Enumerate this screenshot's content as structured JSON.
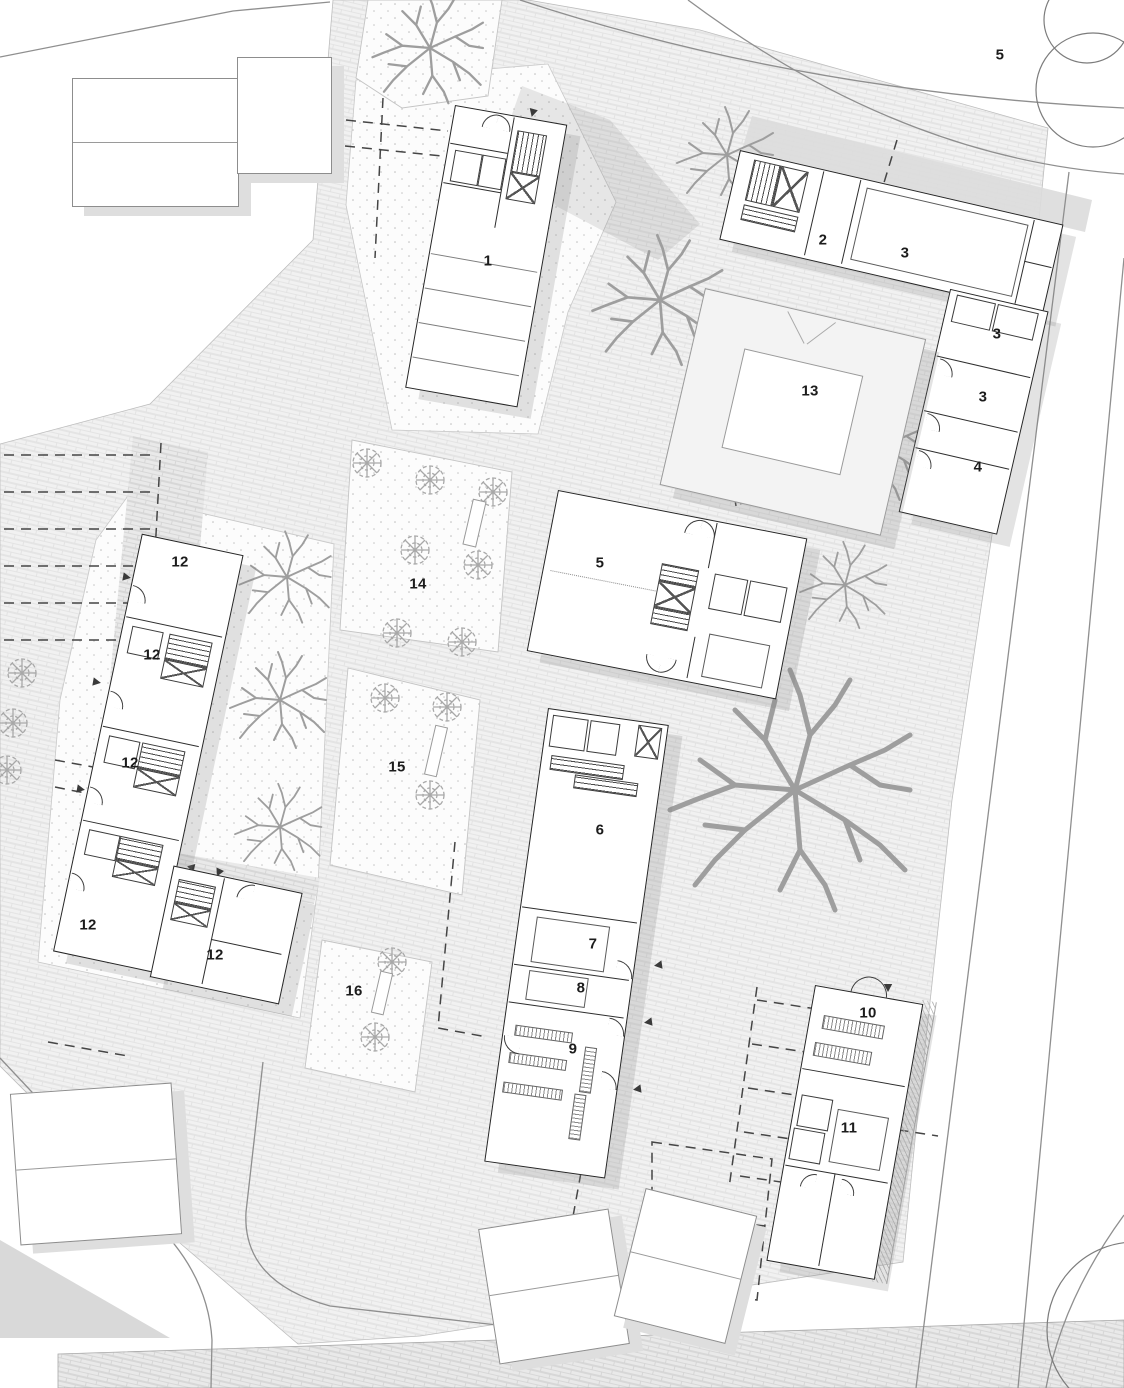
{
  "plan": {
    "title": "residential-site-plan",
    "labels": [
      {
        "id": "bld-1",
        "text": "1",
        "x": 488,
        "y": 261
      },
      {
        "id": "bld-2",
        "text": "2",
        "x": 823,
        "y": 240
      },
      {
        "id": "room-3a",
        "text": "3",
        "x": 905,
        "y": 253
      },
      {
        "id": "room-3b",
        "text": "3",
        "x": 997,
        "y": 334
      },
      {
        "id": "room-3c",
        "text": "3",
        "x": 983,
        "y": 397
      },
      {
        "id": "bld-4",
        "text": "4",
        "x": 978,
        "y": 467
      },
      {
        "id": "street-5",
        "text": "5",
        "x": 1000,
        "y": 55
      },
      {
        "id": "bld-5",
        "text": "5",
        "x": 600,
        "y": 563
      },
      {
        "id": "bld-6",
        "text": "6",
        "x": 600,
        "y": 830
      },
      {
        "id": "bld-7",
        "text": "7",
        "x": 593,
        "y": 944
      },
      {
        "id": "bld-8",
        "text": "8",
        "x": 581,
        "y": 988
      },
      {
        "id": "bld-9",
        "text": "9",
        "x": 573,
        "y": 1049
      },
      {
        "id": "bld-10",
        "text": "10",
        "x": 868,
        "y": 1013
      },
      {
        "id": "bld-11",
        "text": "11",
        "x": 849,
        "y": 1128
      },
      {
        "id": "bld-12a",
        "text": "12",
        "x": 180,
        "y": 562
      },
      {
        "id": "bld-12b",
        "text": "12",
        "x": 152,
        "y": 655
      },
      {
        "id": "bld-12c",
        "text": "12",
        "x": 130,
        "y": 763
      },
      {
        "id": "bld-12d",
        "text": "12",
        "x": 88,
        "y": 925
      },
      {
        "id": "bld-12e",
        "text": "12",
        "x": 215,
        "y": 955
      },
      {
        "id": "bld-13",
        "text": "13",
        "x": 810,
        "y": 391
      },
      {
        "id": "plot-14",
        "text": "14",
        "x": 418,
        "y": 584
      },
      {
        "id": "plot-15",
        "text": "15",
        "x": 397,
        "y": 767
      },
      {
        "id": "plot-16",
        "text": "16",
        "x": 354,
        "y": 991
      }
    ],
    "colors": {
      "new_building_line": "#262626",
      "existing_building_line": "#8d8d8d",
      "tree": "#9e9e9e",
      "paving_joint": "#e2e2e2",
      "shadow": "rgba(128,128,128,0.22)",
      "label": "#1c1c1c"
    }
  }
}
